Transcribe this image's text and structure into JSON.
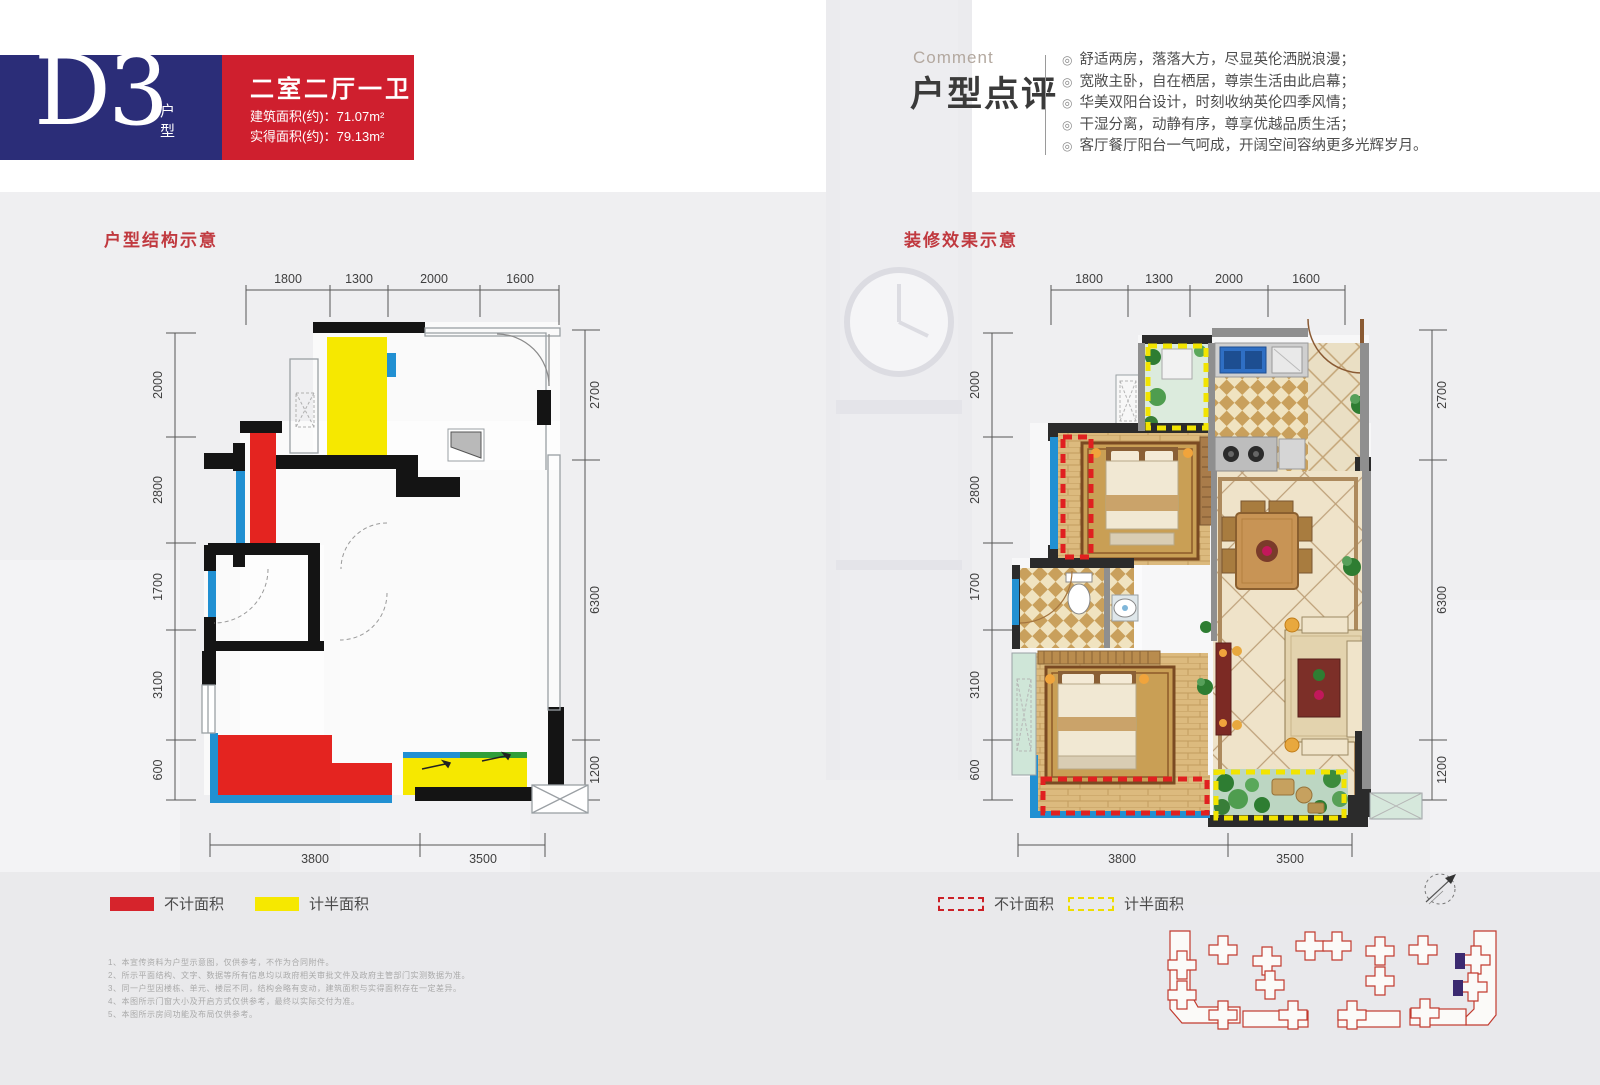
{
  "badge": {
    "code": "D3",
    "code_suffix": "户型",
    "layout_title": "二室二厅一卫",
    "area_lines": [
      "建筑面积(约)：71.07m²",
      "实得面积(约)：79.13m²"
    ]
  },
  "comment": {
    "eyebrow": "Comment",
    "title": "户型点评",
    "bullet_icon": "◎",
    "bullets": [
      "舒适两房，落落大方，尽显英伦洒脱浪漫；",
      "宽敞主卧，自在栖居，尊崇生活由此启幕；",
      "华美双阳台设计，时刻收纳英伦四季风情；",
      "干湿分离，动静有序，尊享优越品质生活；",
      "客厅餐厅阳台一气呵成，开阔空间容纳更多光辉岁月。"
    ]
  },
  "plans": {
    "left_title": "户型结构示意",
    "right_title": "装修效果示意"
  },
  "dims": {
    "top": [
      "1800",
      "1300",
      "2000",
      "1600"
    ],
    "left": [
      "2000",
      "2800",
      "1700",
      "3100",
      "600"
    ],
    "right": [
      "2700",
      "6300",
      "1200"
    ],
    "bottom": [
      "3800",
      "3500"
    ]
  },
  "legend": {
    "solid_red": "不计面积",
    "solid_yellow": "计半面积",
    "dashed_red": "不计面积",
    "dashed_yellow": "计半面积"
  },
  "notes": [
    "1、本宣传资料为户型示意图，仅供参考，不作为合同附件。",
    "2、所示平面结构、文字、数据等所有信息均以政府相关审批文件及政府主管部门实测数据为准。",
    "3、同一户型因楼栋、单元、楼层不同，结构会略有变动，建筑面积与实得面积存在一定差异。",
    "4、本图所示门窗大小及开启方式仅供参考，最终以实际交付为准。",
    "5、本图所示房间功能及布局仅供参考。"
  ],
  "colors": {
    "badge_blue": "#2b2d78",
    "badge_red": "#cf1f2e",
    "plan_red": "#e42420",
    "plan_yellow": "#f6e800",
    "window_blue": "#2190d2",
    "title_red": "#c0393f"
  }
}
